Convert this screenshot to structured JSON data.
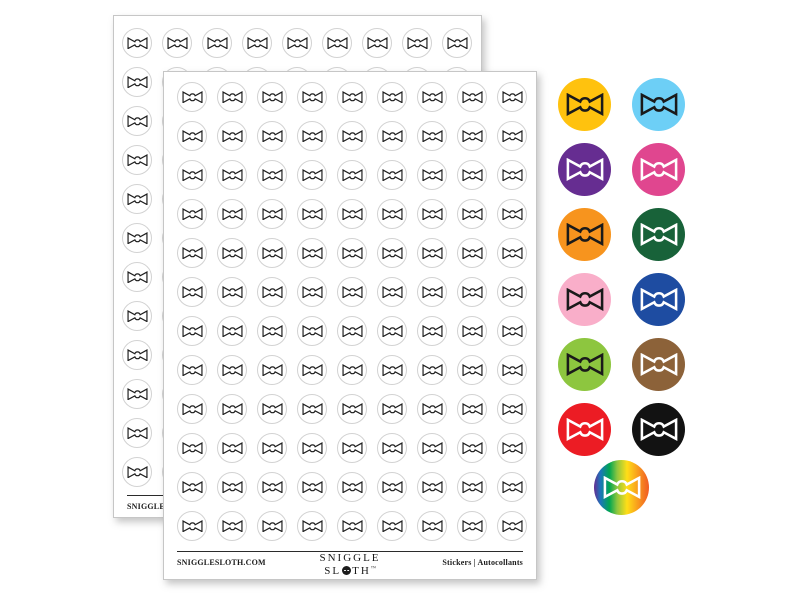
{
  "background": "#ffffff",
  "product": {
    "icon": "bow-tie-icon",
    "website": "SNIGGLESLOTH.COM",
    "type_label": "Stickers  |  Autocollants",
    "logo": {
      "line1": "SNIGGLE",
      "line2_pre": "SL",
      "o_icon": "sloth-face-icon",
      "line2_post": "TH",
      "trademark": "™"
    }
  },
  "sheets": {
    "count": 2,
    "columns": 9,
    "rows": 12,
    "stickers_per_sheet": 108,
    "sticker_shape": "circle",
    "sticker_fill": "#ffffff",
    "sticker_border": "#d2d2d2",
    "bow_outline_color": "#1f1f1f"
  },
  "swatches": [
    {
      "name": "yellow",
      "bg": "#FFC20E",
      "fg": "#1a1a1a"
    },
    {
      "name": "sky-blue",
      "bg": "#6DCFF6",
      "fg": "#1a1a1a"
    },
    {
      "name": "purple",
      "bg": "#662D91",
      "fg": "#ffffff"
    },
    {
      "name": "magenta",
      "bg": "#E0468F",
      "fg": "#ffffff"
    },
    {
      "name": "orange",
      "bg": "#F7941E",
      "fg": "#1a1a1a"
    },
    {
      "name": "forest-green",
      "bg": "#186239",
      "fg": "#ffffff"
    },
    {
      "name": "light-pink",
      "bg": "#F9AEC9",
      "fg": "#1a1a1a"
    },
    {
      "name": "royal-blue",
      "bg": "#1E4CA1",
      "fg": "#ffffff"
    },
    {
      "name": "lime-green",
      "bg": "#8DC63F",
      "fg": "#1a1a1a"
    },
    {
      "name": "brown",
      "bg": "#8C6239",
      "fg": "#ffffff"
    },
    {
      "name": "red",
      "bg": "#EC1C24",
      "fg": "#ffffff"
    },
    {
      "name": "black",
      "bg": "#121212",
      "fg": "#ffffff"
    },
    {
      "name": "rainbow",
      "gradient": [
        "#662D91 0%",
        "#1B75BB 12%",
        "#00A651 28%",
        "#8DC63F 42%",
        "#FFDE17 60%",
        "#F7941E 82%",
        "#F15A24 100%"
      ],
      "fg": "#ffffff"
    }
  ]
}
